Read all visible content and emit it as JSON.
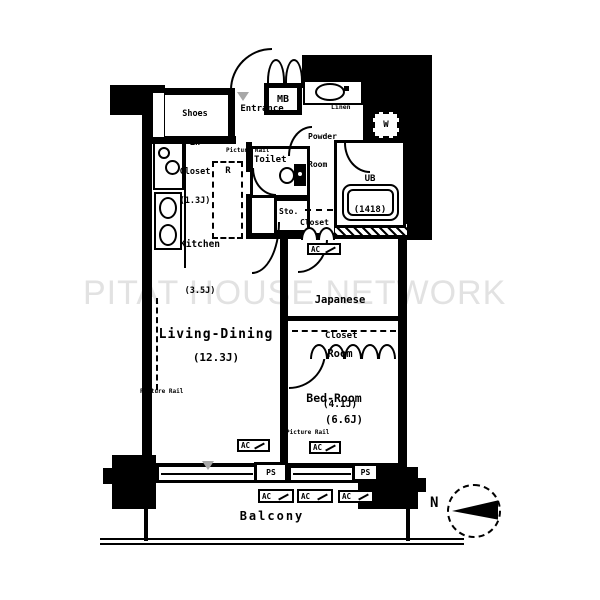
{
  "watermark": "PITAT HOUSE NETWORK",
  "compass": {
    "north": "N"
  },
  "rooms": {
    "shoes_closet": {
      "l1": "Shoes",
      "l2": "in",
      "l3": "Closet",
      "l4": "(1.3J)"
    },
    "entrance": {
      "label": "Entrance"
    },
    "mb": {
      "label": "MB"
    },
    "powder": {
      "l1": "Powder",
      "l2": "Room"
    },
    "linen": {
      "label": "Linen"
    },
    "washer": {
      "label": "W"
    },
    "toilet": {
      "label": "Toilet"
    },
    "ub": {
      "l1": "UB",
      "l2": "(1418)"
    },
    "kitchen": {
      "l1": "Kitchen",
      "l2": "(3.5J)"
    },
    "fridge": {
      "label": "R"
    },
    "storage": {
      "label": "Sto."
    },
    "closet_japanese": {
      "label": "Closet"
    },
    "japanese": {
      "l1": "Japanese",
      "l2": "Room",
      "l3": "(4.1J)"
    },
    "closet_bedroom": {
      "label": "Closet"
    },
    "bedroom": {
      "l1": "Bed-Room",
      "l2": "(6.6J)"
    },
    "living": {
      "l1": "Living-Dining",
      "l2": "(12.3J)"
    },
    "balcony": {
      "label": "Balcony"
    }
  },
  "annotations": {
    "picture_rail": "Picture Rail",
    "ac": "AC",
    "ps": "PS"
  },
  "colors": {
    "wall": "#000000",
    "watermark": "#e2e2e2",
    "marker": "#a8a8a8"
  }
}
